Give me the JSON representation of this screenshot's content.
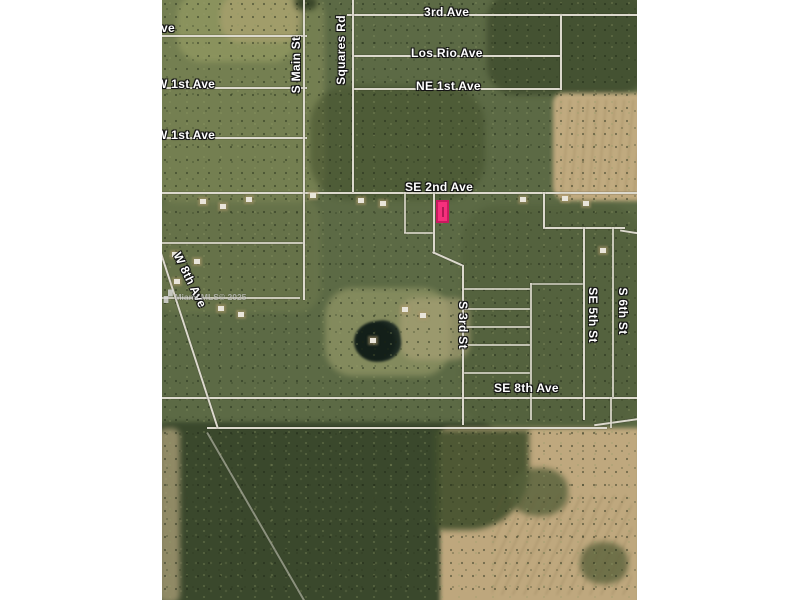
{
  "map": {
    "description": "satellite-parcel-map",
    "labels": {
      "ave_partial": "ve",
      "w1st_upper": "W 1st Ave",
      "w1st_lower": "W 1st Ave",
      "third_ave": "3rd Ave",
      "los_rio": "Los Rio Ave",
      "ne1st": "NE 1st Ave",
      "se2nd": "SE 2nd Ave",
      "se8th": "SE 8th Ave",
      "s_main": "S Main St",
      "squares_rd": "Squares Rd",
      "s3rd": "S 3rd St",
      "se5th": "SE 5th St",
      "s6th": "S 6th St",
      "w8th": "W 8th Ave"
    },
    "watermark": "Miami MLS© 2025",
    "marker": {
      "label": "",
      "fill": "#f5307c",
      "border": "#c9195f"
    },
    "colors": {
      "terrain_base": "#5c6a45",
      "field_tan": "#c6ae83",
      "forest_dark": "#37452a",
      "road": "#dcd9cd",
      "label_text": "#ffffff",
      "margin": "#ffffff"
    }
  }
}
